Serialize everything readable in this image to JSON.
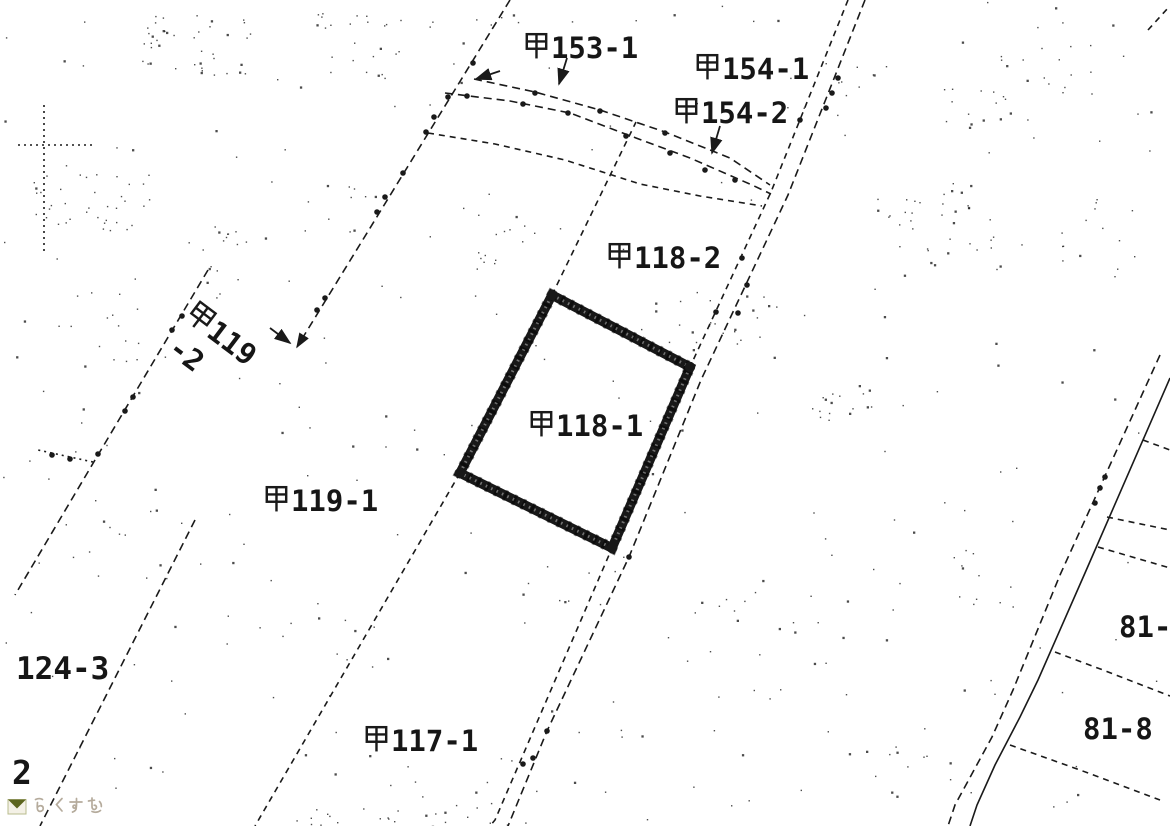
{
  "page": {
    "width": 1170,
    "height": 826,
    "background": "#ffffff",
    "ink": "#1a1a1a"
  },
  "watermark": {
    "text": "らくすむ",
    "text_color": "#b5ab9c",
    "icon": "rakusumu-logo-icon",
    "icon_dark_color": "#5c651e",
    "icon_light_color": "#b9bc8d"
  },
  "map": {
    "ink": "#1a1a1a",
    "highlight_parcel": {
      "label": "甲118-1",
      "points": [
        [
          552,
          295
        ],
        [
          690,
          367
        ],
        [
          612,
          548
        ],
        [
          460,
          473
        ]
      ],
      "stroke_width": 9.5
    },
    "labels": [
      {
        "id": "koh-153-1",
        "text": "甲153-1",
        "x": 523,
        "y": 31
      },
      {
        "id": "koh-154-1",
        "text": "甲154-1",
        "x": 694,
        "y": 52
      },
      {
        "id": "koh-154-2",
        "text": "甲154-2",
        "x": 673,
        "y": 96
      },
      {
        "id": "koh-118-2",
        "text": "甲118-2",
        "x": 606,
        "y": 241
      },
      {
        "id": "koh-118-1",
        "text": "甲118-1",
        "x": 528,
        "y": 409
      },
      {
        "id": "koh-119",
        "text": "甲119",
        "x": 199,
        "y": 297,
        "rotate": 37
      },
      {
        "id": "koh-119-2",
        "text": "-2",
        "x": 181,
        "y": 333,
        "rotate": 37
      },
      {
        "id": "koh-119-1",
        "text": "甲119-1",
        "x": 263,
        "y": 484
      },
      {
        "id": "124-3",
        "text": "124-3",
        "x": 16,
        "y": 654,
        "size": 31
      },
      {
        "id": "2",
        "text": "2",
        "x": 12,
        "y": 756,
        "size": 33
      },
      {
        "id": "koh-117-1",
        "text": "甲117-1",
        "x": 363,
        "y": 724
      },
      {
        "id": "81",
        "text": "81-",
        "x": 1119,
        "y": 613
      },
      {
        "id": "81-8",
        "text": "81-8",
        "x": 1083,
        "y": 715
      }
    ],
    "lines": [
      {
        "name": "boundary-a",
        "style": "dashdot",
        "arrow_end": true,
        "points": [
          [
            510,
            0
          ],
          [
            297,
            347
          ]
        ],
        "dots": [
          [
            473,
            63
          ],
          [
            448,
            97
          ],
          [
            434,
            117
          ],
          [
            426,
            132
          ],
          [
            403,
            173
          ],
          [
            385,
            197
          ],
          [
            377,
            212
          ],
          [
            325,
            298
          ],
          [
            317,
            310
          ]
        ]
      },
      {
        "name": "boundary-b",
        "style": "dashdot",
        "points": [
          [
            208,
            270
          ],
          [
            95,
            460
          ],
          [
            15,
            595
          ]
        ],
        "dots": [
          [
            182,
            316
          ],
          [
            172,
            330
          ],
          [
            133,
            397
          ],
          [
            125,
            411
          ],
          [
            98,
            454
          ]
        ]
      },
      {
        "name": "boundary-b-branch",
        "style": "dot",
        "points": [
          [
            93,
            462
          ],
          [
            38,
            450
          ]
        ],
        "dots": [
          [
            70,
            459
          ],
          [
            52,
            455
          ]
        ]
      },
      {
        "name": "boundary-c",
        "style": "dash",
        "points": [
          [
            460,
            473
          ],
          [
            255,
            826
          ]
        ]
      },
      {
        "name": "boundary-d",
        "style": "dashdot",
        "points": [
          [
            195,
            520
          ],
          [
            40,
            826
          ]
        ]
      },
      {
        "name": "boundary-e",
        "style": "dash",
        "points": [
          [
            552,
            295
          ],
          [
            636,
            122
          ]
        ]
      },
      {
        "name": "road-ne-left",
        "style": "dash",
        "points": [
          [
            848,
            0
          ],
          [
            771,
            192
          ],
          [
            690,
            367
          ],
          [
            612,
            548
          ],
          [
            495,
            820
          ],
          [
            490,
            826
          ]
        ],
        "dots": [
          [
            800,
            120
          ],
          [
            742,
            258
          ],
          [
            716,
            312
          ],
          [
            523,
            764
          ]
        ]
      },
      {
        "name": "road-ne-right",
        "style": "dashdot",
        "points": [
          [
            865,
            0
          ],
          [
            788,
            195
          ],
          [
            701,
            380
          ],
          [
            629,
            557
          ],
          [
            547,
            731
          ],
          [
            508,
            826
          ]
        ],
        "dots": [
          [
            838,
            78
          ],
          [
            832,
            93
          ],
          [
            826,
            108
          ],
          [
            747,
            285
          ],
          [
            738,
            313
          ],
          [
            629,
            557
          ],
          [
            547,
            731
          ],
          [
            533,
            758
          ]
        ]
      },
      {
        "name": "road-curve-top",
        "style": "dashdot",
        "points": [
          [
            474,
            79
          ],
          [
            535,
            92
          ],
          [
            600,
            110
          ],
          [
            665,
            132
          ],
          [
            730,
            158
          ],
          [
            770,
            185
          ]
        ],
        "dots": [
          [
            535,
            93
          ],
          [
            600,
            111
          ],
          [
            665,
            133
          ]
        ]
      },
      {
        "name": "road-curve-mid",
        "style": "dashdot",
        "points": [
          [
            445,
            93
          ],
          [
            510,
            101
          ],
          [
            570,
            113
          ],
          [
            628,
            135
          ],
          [
            690,
            158
          ],
          [
            752,
            185
          ],
          [
            771,
            194
          ]
        ],
        "dots": [
          [
            467,
            96
          ],
          [
            523,
            104
          ],
          [
            568,
            113
          ],
          [
            626,
            136
          ],
          [
            670,
            153
          ],
          [
            705,
            170
          ],
          [
            735,
            180
          ]
        ]
      },
      {
        "name": "road-curve-low",
        "style": "dash",
        "points": [
          [
            428,
            133
          ],
          [
            495,
            144
          ],
          [
            565,
            160
          ],
          [
            640,
            184
          ],
          [
            700,
            196
          ],
          [
            762,
            206
          ]
        ]
      },
      {
        "name": "road-se-left",
        "style": "dashdot",
        "points": [
          [
            1160,
            355
          ],
          [
            1060,
            575
          ],
          [
            1013,
            690
          ],
          [
            992,
            737
          ],
          [
            955,
            805
          ],
          [
            948,
            826
          ]
        ],
        "dots": [
          [
            1105,
            477
          ],
          [
            1100,
            488
          ],
          [
            1095,
            503
          ]
        ]
      },
      {
        "name": "road-se-right",
        "style": "solid",
        "points": [
          [
            1170,
            378
          ],
          [
            1085,
            573
          ],
          [
            1038,
            680
          ],
          [
            1020,
            717
          ],
          [
            995,
            765
          ],
          [
            977,
            805
          ],
          [
            970,
            826
          ]
        ]
      },
      {
        "name": "branch-1",
        "style": "dash",
        "points": [
          [
            1143,
            440
          ],
          [
            1170,
            450
          ]
        ]
      },
      {
        "name": "branch-2",
        "style": "dash",
        "points": [
          [
            1107,
            517
          ],
          [
            1170,
            530
          ]
        ]
      },
      {
        "name": "branch-3",
        "style": "dash",
        "points": [
          [
            1098,
            547
          ],
          [
            1170,
            568
          ]
        ]
      },
      {
        "name": "parcel-81-divider",
        "style": "dash",
        "points": [
          [
            1055,
            652
          ],
          [
            1103,
            670
          ],
          [
            1170,
            696
          ]
        ]
      },
      {
        "name": "parcel-81-8-divider",
        "style": "dash",
        "points": [
          [
            1010,
            745
          ],
          [
            1080,
            770
          ],
          [
            1160,
            800
          ]
        ]
      },
      {
        "name": "corner-line-topright",
        "style": "dash",
        "points": [
          [
            1148,
            30
          ],
          [
            1168,
            8
          ]
        ]
      },
      {
        "name": "faint-line-vertical",
        "style": "dot",
        "points": [
          [
            44,
            105
          ],
          [
            44,
            253
          ]
        ]
      },
      {
        "name": "faint-line-horizontal",
        "style": "dot",
        "points": [
          [
            18,
            145
          ],
          [
            95,
            145
          ]
        ]
      }
    ],
    "arrows": [
      {
        "name": "leader-153-1",
        "from": [
          567,
          58
        ],
        "to": [
          559,
          84
        ]
      },
      {
        "name": "leader-road-end",
        "from": [
          500,
          71
        ],
        "to": [
          476,
          79
        ]
      },
      {
        "name": "leader-154-2",
        "from": [
          720,
          126
        ],
        "to": [
          712,
          153
        ]
      },
      {
        "name": "leader-119-2",
        "from": [
          270,
          328
        ],
        "to": [
          290,
          343
        ]
      }
    ]
  }
}
